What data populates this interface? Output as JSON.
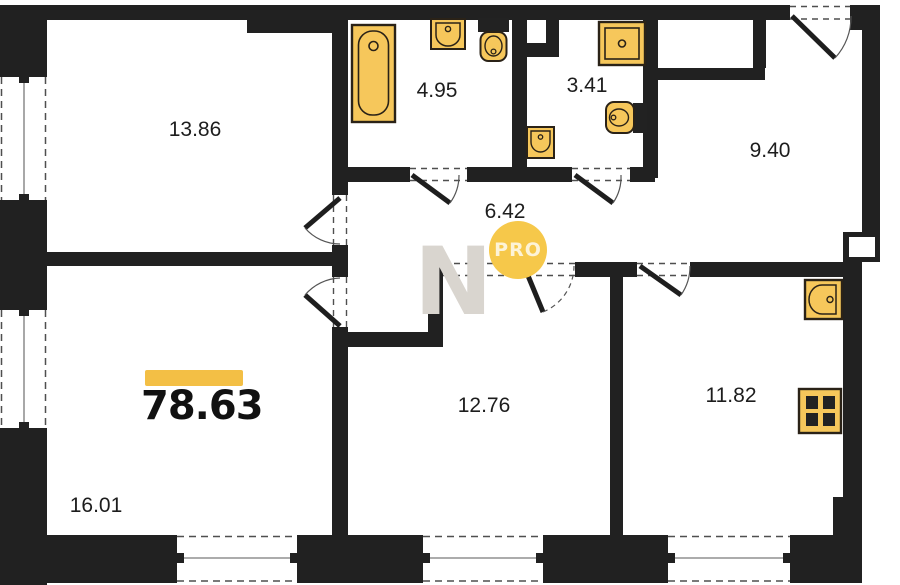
{
  "plan_title": "apartment-floor-plan",
  "total": {
    "area": "78.63"
  },
  "rooms": [
    {
      "id": "bedroom-top-left",
      "area": "13.86",
      "cx": 195,
      "cy": 130
    },
    {
      "id": "bathroom",
      "area": "4.95",
      "cx": 437,
      "cy": 91
    },
    {
      "id": "wc",
      "area": "3.41",
      "cx": 587,
      "cy": 86
    },
    {
      "id": "entry-hall",
      "area": "9.40",
      "cx": 770,
      "cy": 151
    },
    {
      "id": "corridor",
      "area": "6.42",
      "cx": 505,
      "cy": 212
    },
    {
      "id": "bedroom-bottom-middle",
      "area": "12.76",
      "cx": 484,
      "cy": 406
    },
    {
      "id": "kitchen",
      "area": "11.82",
      "cx": 731,
      "cy": 396
    },
    {
      "id": "living-room",
      "area": "16.01",
      "cx": 96,
      "cy": 506
    }
  ],
  "watermark": {
    "letter": "N",
    "badge": "PRO"
  },
  "fixtures": [
    "bathtub",
    "sink",
    "toilet",
    "shower-cabin",
    "wash-basin",
    "toilet",
    "kitchen-sink",
    "stove"
  ],
  "colors": {
    "wall": "#212121",
    "fixture_fill": "#f6c75b",
    "fixture_stroke": "#2a2217",
    "accent_bar": "#f3bf45",
    "badge": "#f6c84a",
    "dash": "#4f4f4f"
  }
}
